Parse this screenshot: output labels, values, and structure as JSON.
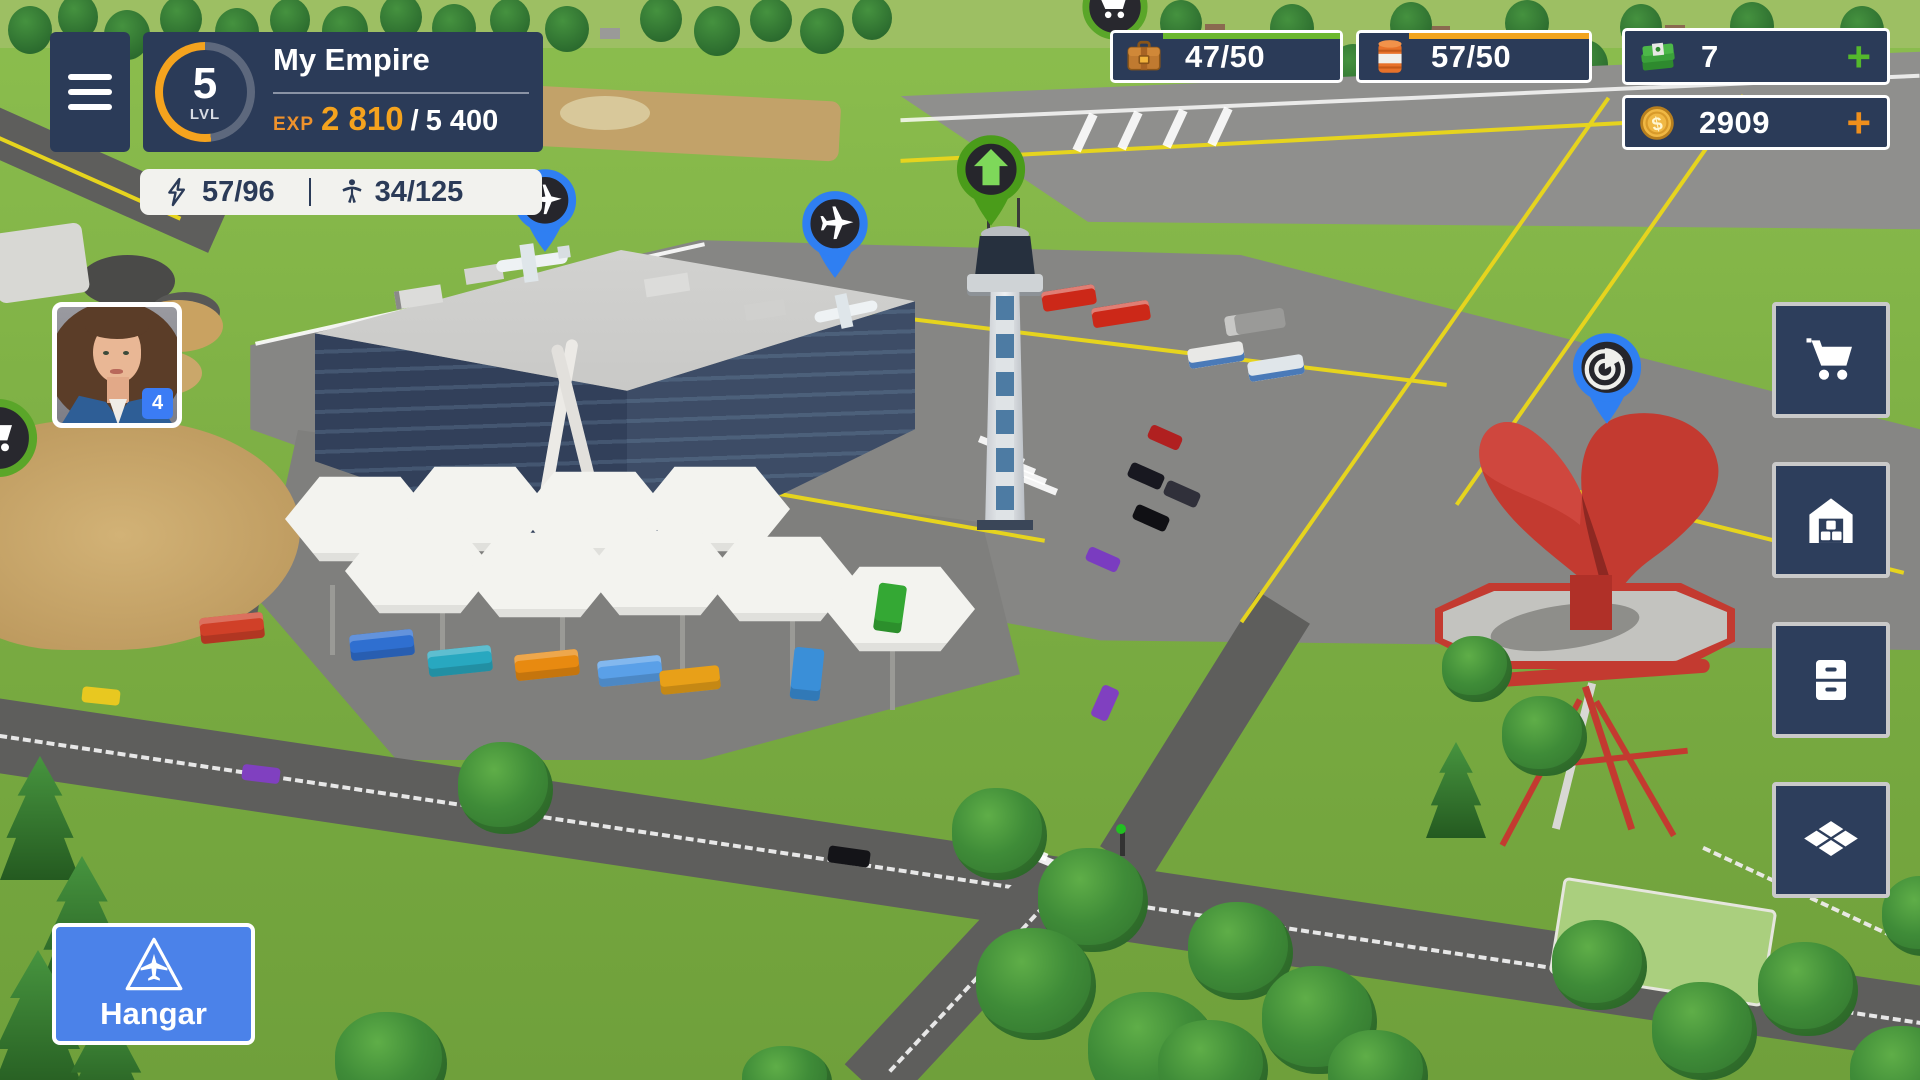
{
  "header": {
    "level": "5",
    "level_label": "LVL",
    "empire_name": "My Empire",
    "exp_label": "EXP",
    "exp_current": "2 810",
    "exp_separator": "/",
    "exp_max": "5 400",
    "exp_progress_pct": 52
  },
  "stats": {
    "energy": "57/96",
    "population": "34/125"
  },
  "resources": {
    "cargo": "47/50",
    "fuel": "57/50",
    "cash": "7",
    "coins": "2909",
    "plus": "+"
  },
  "avatar": {
    "badge_count": "4"
  },
  "hangar": {
    "label": "Hangar"
  },
  "icons": {
    "menu": "hamburger-icon",
    "energy": "lightning-icon",
    "population": "person-icon",
    "cargo": "briefcase-icon",
    "fuel": "barrel-icon",
    "cash": "banknotes-icon",
    "coins": "coin-icon",
    "side_buttons": [
      "cart-icon",
      "warehouse-icon",
      "drawers-icon",
      "tiles-icon"
    ],
    "markers": [
      "plane-icon",
      "plane-icon",
      "up-arrow-icon",
      "radar-icon",
      "cart-icon",
      "cart-icon"
    ],
    "hangar": "plane-triangle-icon"
  },
  "colors": {
    "panel_navy": "#2b3b58",
    "accent_orange": "#f5a31e",
    "progress_green": "#6cb82e",
    "progress_orange": "#f2a41e",
    "plus_green": "#54b82c",
    "plus_orange": "#ef8f1c",
    "hangar_blue": "#4b82e9",
    "marker_blue": "#2f7ff2",
    "marker_green": "#4a9c1a",
    "badge_blue": "#3b7cf5",
    "stats_bg": "#f2f2ee"
  }
}
